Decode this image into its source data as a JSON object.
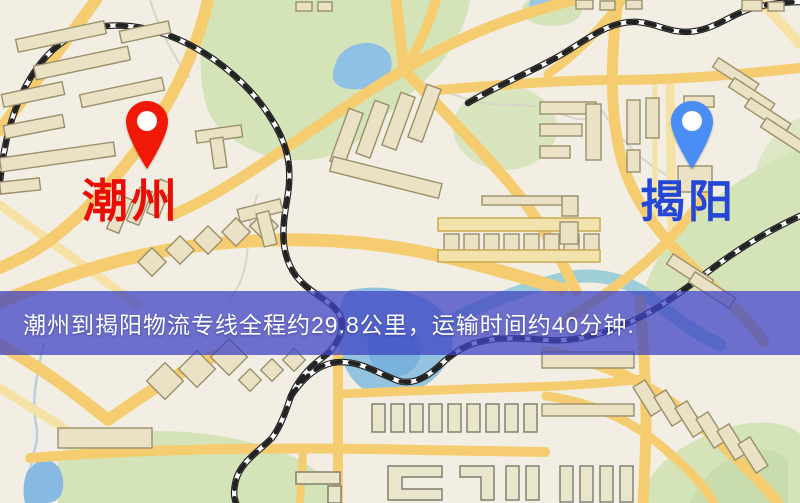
{
  "banner": {
    "text": "潮州到揭阳物流专线全程约29.8公里，运输时间约40分钟.",
    "background_color": "#3f44c3",
    "text_color": "#ffffff"
  },
  "markers": {
    "origin": {
      "label": "潮州",
      "icon": "red-location-pin",
      "pin_color": "#f21807",
      "label_color": "#e90d06"
    },
    "destination": {
      "label": "揭阳",
      "icon": "blue-location-pin",
      "pin_color": "#4a8ef5",
      "label_color": "#2447d6"
    }
  },
  "map_colors": {
    "background": "#f2eee3",
    "road_major": "#f5cd70",
    "road_pale": "#f5e2a4",
    "park_green": "#d4e3b8",
    "water_blue": "#8fc1e4",
    "river_teal": "#9ecfd8",
    "railway_black": "#222222",
    "building_fill": "#ebe1c5"
  }
}
